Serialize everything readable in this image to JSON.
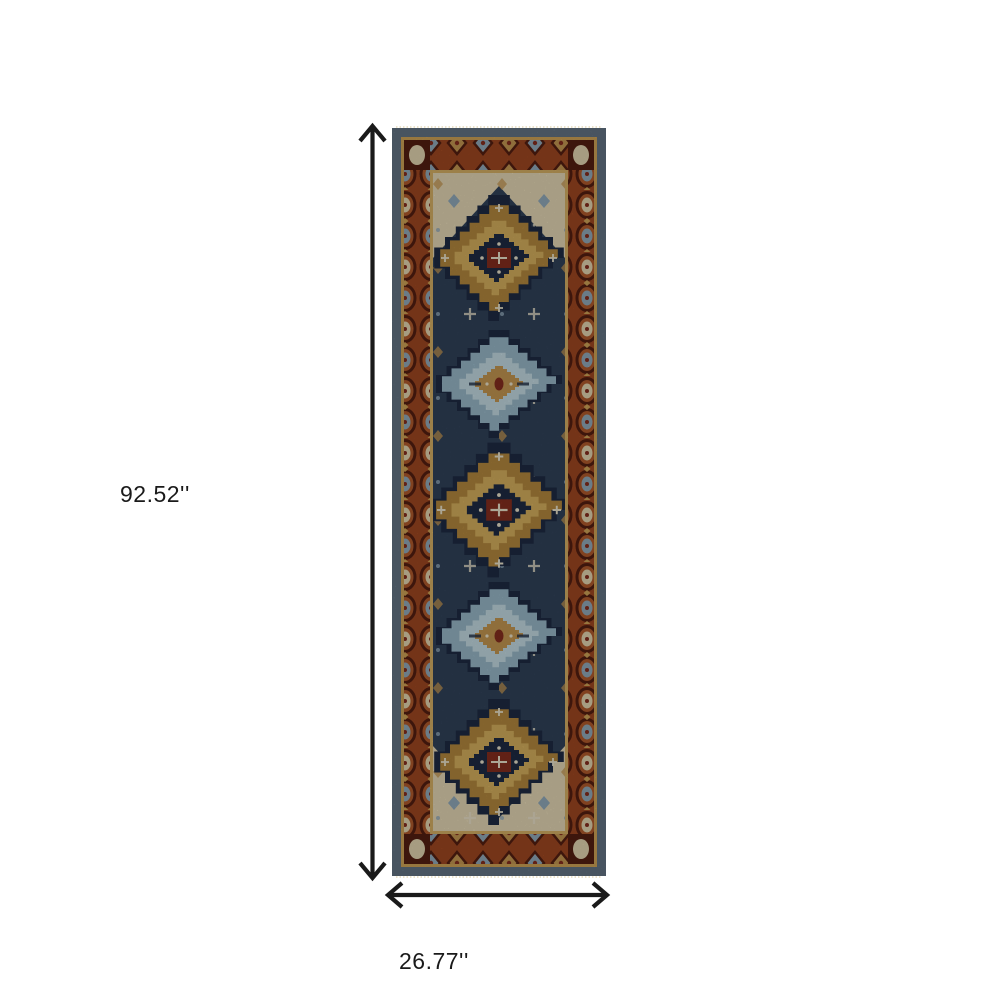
{
  "page": {
    "background_color": "#ffffff"
  },
  "annotations": {
    "height_label": "92.52''",
    "width_label": "26.77''",
    "arrow_color": "#1a1a1a",
    "label_color": "#1a1a1a"
  },
  "rug": {
    "type": "oriental-medallion-runner",
    "medallion_sequence": [
      "gold",
      "blue",
      "gold",
      "blue",
      "gold"
    ],
    "palette": {
      "fringe": "#ece4cc",
      "outer_band": "#5d6d7c",
      "guard_gold": "#c39a52",
      "border_rust": "#96431f",
      "border_dark": "#4f1d10",
      "border_accent_rust": "#a6552a",
      "motif_cream": "#d6c9a6",
      "motif_slate": "#89a0b0",
      "inner_guard": "#c9a55e",
      "field_navy": "#2e3e54",
      "corner_cream": "#d7cbaa",
      "medallion_halo": "#1d2940",
      "medallion_gold": "#a9803a",
      "medallion_gold_light": "#c9a558",
      "medallion_blue": "#8fadbc",
      "medallion_blue_light": "#b9cfd6",
      "accent_maroon": "#7e2b1d",
      "accent_tan": "#b98e4d",
      "accent_white": "#ddd6c0"
    }
  }
}
